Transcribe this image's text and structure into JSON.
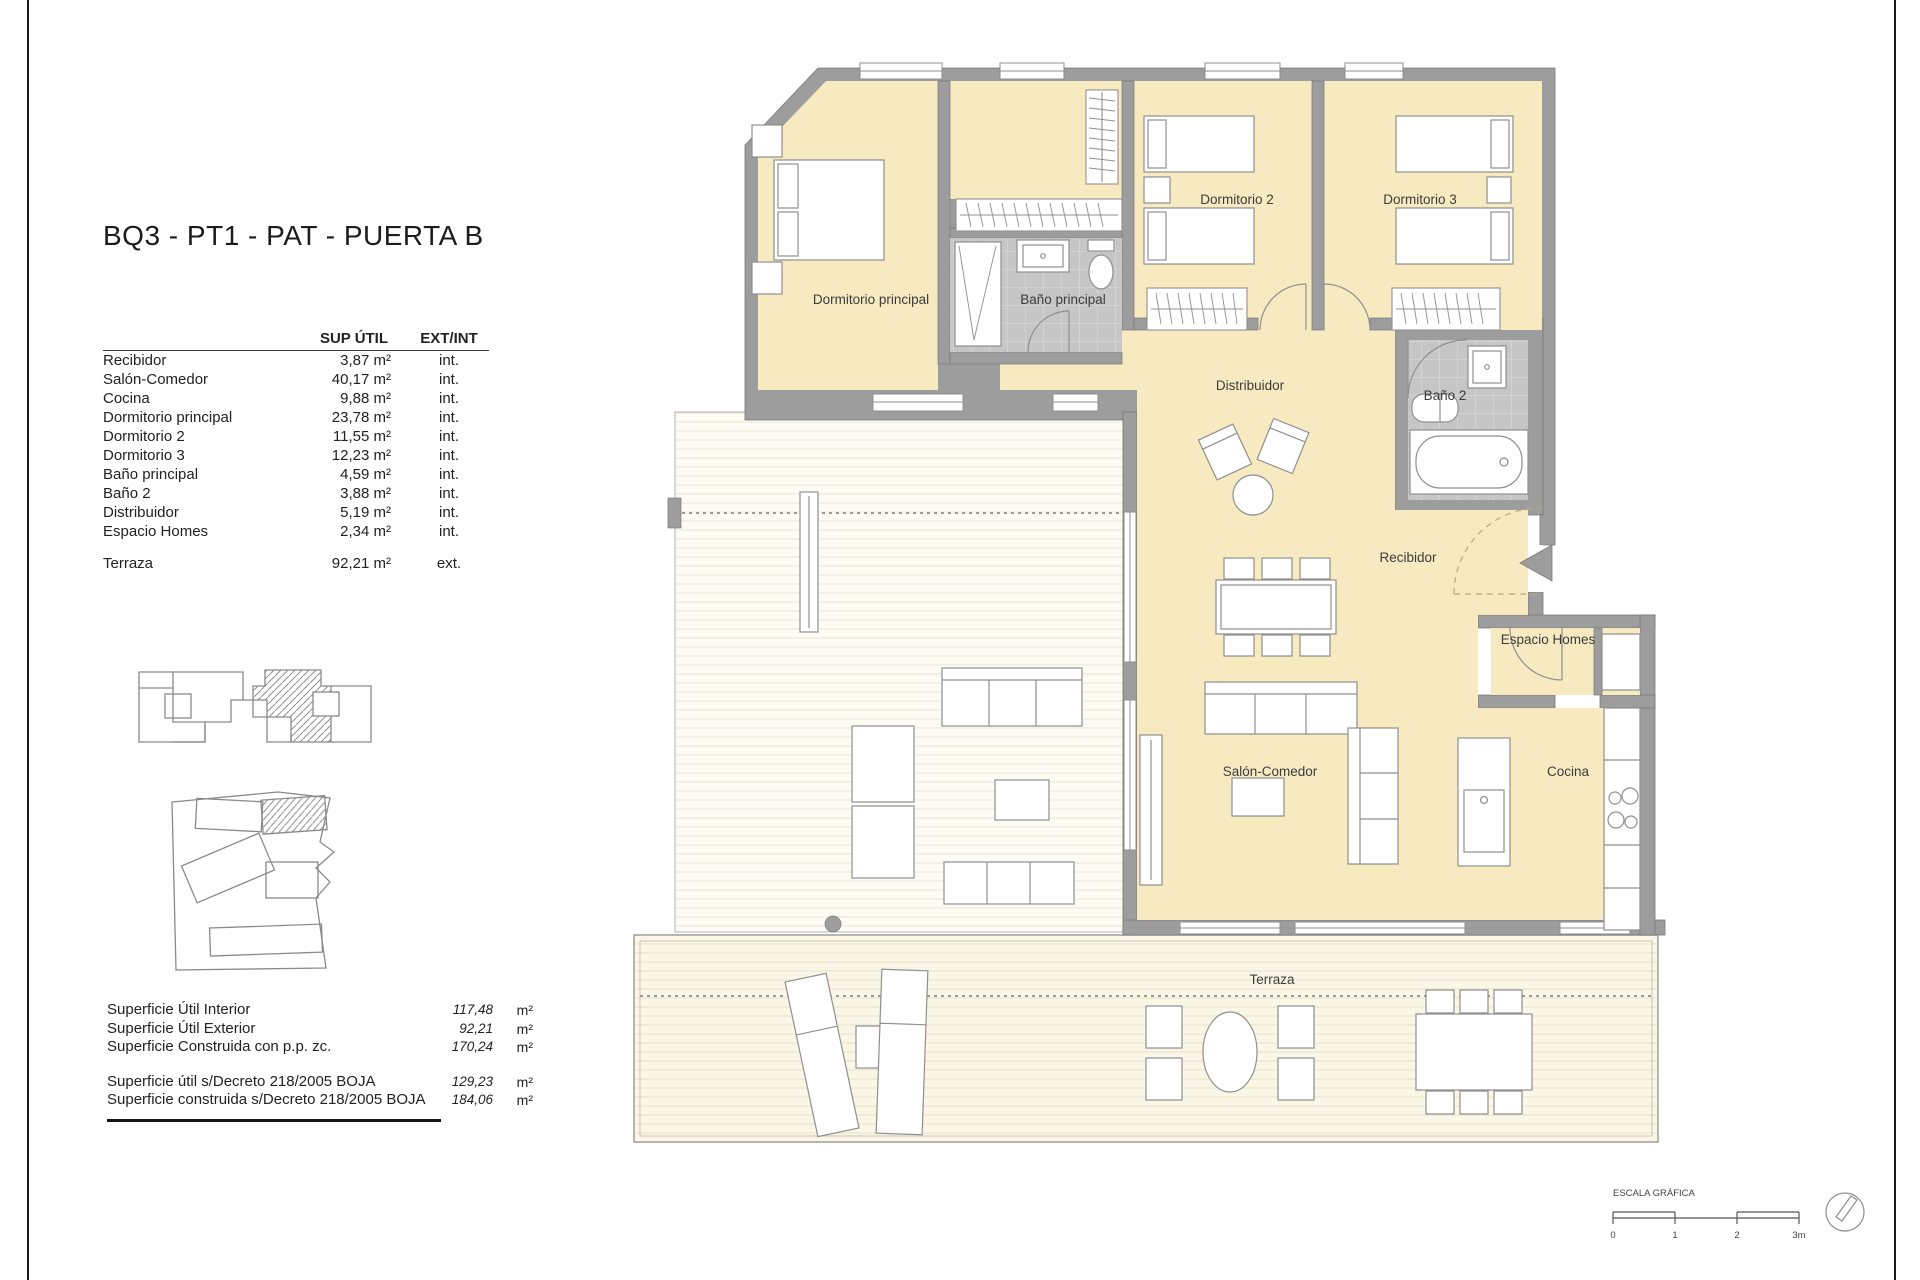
{
  "title": "BQ3 - PT1 - PAT - PUERTA B",
  "table": {
    "headers": {
      "area": "SUP ÚTIL",
      "type": "EXT/INT"
    },
    "rows": [
      {
        "name": "Recibidor",
        "area": "3,87 m²",
        "type": "int."
      },
      {
        "name": "Salón-Comedor",
        "area": "40,17 m²",
        "type": "int."
      },
      {
        "name": "Cocina",
        "area": "9,88 m²",
        "type": "int."
      },
      {
        "name": "Dormitorio principal",
        "area": "23,78 m²",
        "type": "int."
      },
      {
        "name": "Dormitorio 2",
        "area": "11,55 m²",
        "type": "int."
      },
      {
        "name": "Dormitorio 3",
        "area": "12,23 m²",
        "type": "int."
      },
      {
        "name": "Baño principal",
        "area": "4,59 m²",
        "type": "int."
      },
      {
        "name": "Baño 2",
        "area": "3,88 m²",
        "type": "int."
      },
      {
        "name": "Distribuidor",
        "area": "5,19 m²",
        "type": "int."
      },
      {
        "name": "Espacio Homes",
        "area": "2,34 m²",
        "type": "int."
      }
    ],
    "terraza": {
      "name": "Terraza",
      "area": "92,21 m²",
      "type": "ext."
    }
  },
  "summary": {
    "rows": [
      {
        "label": "Superficie Útil Interior",
        "value": "117,48",
        "unit": "m²"
      },
      {
        "label": "Superficie Útil Exterior",
        "value": "92,21",
        "unit": "m²"
      },
      {
        "label": "Superficie Construida con p.p. zc.",
        "value": "170,24",
        "unit": "m²"
      },
      {
        "label": "Superficie útil s/Decreto 218/2005 BOJA",
        "value": "129,23",
        "unit": "m²"
      },
      {
        "label": "Superficie construida s/Decreto 218/2005 BOJA",
        "value": "184,06",
        "unit": "m²"
      }
    ]
  },
  "plan": {
    "rooms": {
      "dormitorio_principal": "Dormitorio principal",
      "bano_principal": "Baño principal",
      "dormitorio_2": "Dormitorio 2",
      "dormitorio_3": "Dormitorio 3",
      "distribuidor": "Distribuidor",
      "bano_2": "Baño 2",
      "recibidor": "Recibidor",
      "espacio_homes": "Espacio Homes",
      "salon_comedor": "Salón-Comedor",
      "cocina": "Cocina",
      "terraza": "Terraza"
    }
  },
  "scale": {
    "title": "ESCALA GRÁFICA",
    "ticks": [
      "0",
      "1",
      "2",
      "3m"
    ]
  },
  "colors": {
    "room_fill": "#f7eac0",
    "wall": "#9d9d9d",
    "bath_tile": "#c6c6c6",
    "accent_line": "#8f8f8f"
  }
}
